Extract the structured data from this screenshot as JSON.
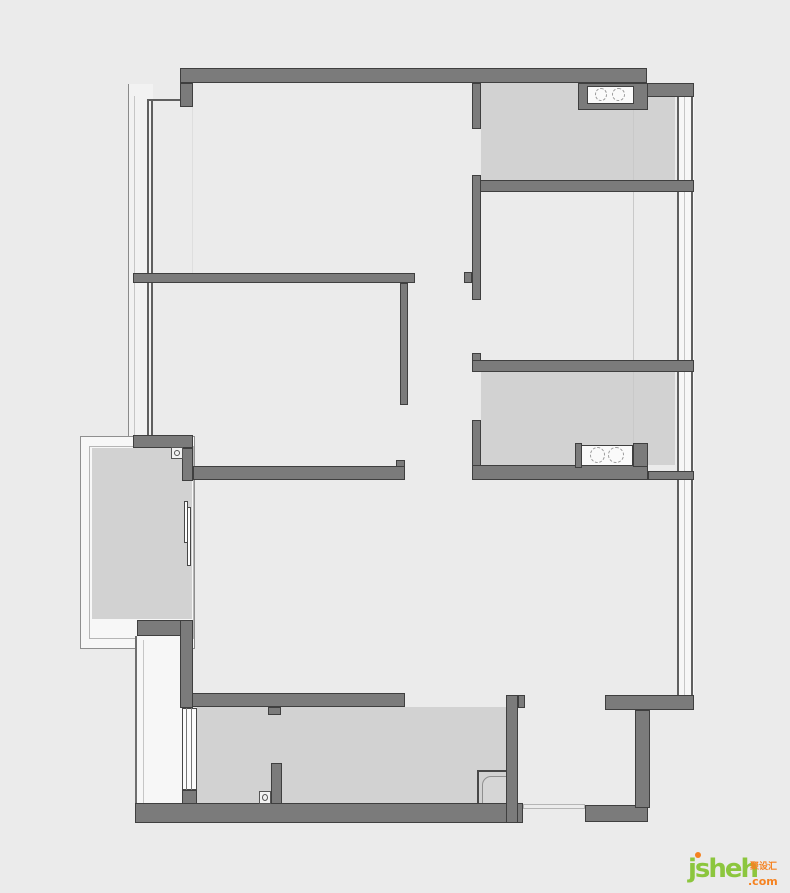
{
  "canvas": {
    "width": 790,
    "height": 893,
    "bg": "#ebebeb"
  },
  "palette": {
    "bg": "#ebebeb",
    "wall": "#7b7b7b",
    "wallEdge": "#3f3f3f",
    "shade": "#d2d2d2",
    "white": "#f7f7f7",
    "glass": "#fbfbfb",
    "lineDark": "#5f5f5f",
    "lineFaint": "#c6c6c6",
    "edge": "#8f8f8f",
    "inner": "#b5b5b5",
    "iconEdge": "#474747",
    "green": "#8cc63e",
    "orange": "#f58220"
  },
  "watermark": {
    "brand": "jsheh",
    "tld": ".com",
    "cjk": "聚设汇",
    "green": "#8cc63e",
    "orange": "#f58220"
  },
  "elements": [
    {
      "n": "left-window-band-upper",
      "fill": "#f2f2f2",
      "x": 128,
      "y": 84,
      "w": 25,
      "h": 352
    },
    {
      "n": "balcony-frame-outer",
      "fill": "$white",
      "stroke": "$edge",
      "sw": 1,
      "x": 80,
      "y": 436,
      "w": 115,
      "h": 213
    },
    {
      "n": "balcony-frame-inner-line",
      "stroke": "$inner",
      "sw": 1,
      "x": 89,
      "y": 446,
      "w": 105,
      "h": 193
    },
    {
      "n": "left-window-band-lower",
      "fill": "$white",
      "x": 135,
      "y": 636,
      "w": 47,
      "h": 168
    },
    {
      "n": "right-window-band",
      "fill": "$white",
      "x": 677,
      "y": 97,
      "w": 17,
      "h": 613
    },
    {
      "n": "room-balcony",
      "fill": "$shade",
      "x": 92,
      "y": 448,
      "w": 100,
      "h": 171
    },
    {
      "n": "room-bathroom-top",
      "fill": "$shade",
      "x": 481,
      "y": 83,
      "w": 194,
      "h": 97
    },
    {
      "n": "room-bathroom-mid",
      "fill": "$shade",
      "x": 481,
      "y": 372,
      "w": 194,
      "h": 93
    },
    {
      "n": "room-kitchen",
      "fill": "$shade",
      "x": 197,
      "y": 707,
      "w": 309,
      "h": 97
    },
    {
      "n": "shadow-line-living",
      "fill": "#dedede",
      "x": 192,
      "y": 85,
      "w": 1,
      "h": 188
    },
    {
      "n": "shadow-line-right",
      "fill": "#c9c9c9",
      "x": 633,
      "y": 84,
      "w": 1,
      "h": 381
    },
    {
      "n": "window-line-outer-left",
      "fill": "#8a8a8a",
      "x": 128,
      "y": 84,
      "w": 1,
      "h": 352
    },
    {
      "n": "window-line-faint-left",
      "fill": "$lineFaint",
      "x": 134,
      "y": 96,
      "w": 1,
      "h": 340
    },
    {
      "n": "window-glass-line-left-a",
      "fill": "$lineDark",
      "x": 147,
      "y": 99,
      "w": 2,
      "h": 337
    },
    {
      "n": "window-glass-line-left-b",
      "fill": "$lineDark",
      "x": 151,
      "y": 99,
      "w": 2,
      "h": 337
    },
    {
      "n": "window-glass-top-connector",
      "fill": "$lineDark",
      "x": 147,
      "y": 99,
      "w": 46,
      "h": 2
    },
    {
      "n": "window-line-lower-a",
      "fill": "#6f6f6f",
      "x": 135,
      "y": 636,
      "w": 2,
      "h": 168
    },
    {
      "n": "window-line-lower-faint",
      "fill": "$lineFaint",
      "x": 143,
      "y": 640,
      "w": 1,
      "h": 164
    },
    {
      "n": "window-glass-right-a",
      "fill": "$lineDark",
      "x": 677,
      "y": 97,
      "w": 2,
      "h": 613
    },
    {
      "n": "window-glass-right-mid",
      "fill": "$lineFaint",
      "x": 684,
      "y": 97,
      "w": 1,
      "h": 613
    },
    {
      "n": "window-glass-right-b",
      "fill": "$lineDark",
      "x": 691,
      "y": 97,
      "w": 2,
      "h": 613
    },
    {
      "n": "kitchen-window-glass",
      "fill": "$glass",
      "stroke": "$iconEdge",
      "sw": 1,
      "x": 182,
      "y": 708,
      "w": 15,
      "h": 82
    },
    {
      "n": "kitchen-window-line-a",
      "fill": "#777777",
      "x": 186,
      "y": 708,
      "w": 1,
      "h": 82
    },
    {
      "n": "kitchen-window-line-b",
      "fill": "#777777",
      "x": 191,
      "y": 708,
      "w": 1,
      "h": 82
    },
    {
      "n": "balcony-door-panel-a",
      "fill": "#fdfdfd",
      "stroke": "$iconEdge",
      "sw": 1,
      "x": 184,
      "y": 501,
      "w": 4,
      "h": 42
    },
    {
      "n": "balcony-door-panel-b",
      "fill": "#fdfdfd",
      "stroke": "$iconEdge",
      "sw": 1,
      "x": 187,
      "y": 507,
      "w": 4,
      "h": 59
    },
    {
      "n": "kitchen-corner-box",
      "fill": "$shade",
      "stroke": "#474747",
      "sw": 2,
      "x": 477,
      "y": 770,
      "w": 32,
      "h": 35
    },
    {
      "n": "kitchen-corner-box-inner",
      "fill": "#d6d6d6",
      "stroke": "#8f8f8f",
      "sw": 1,
      "rad": "9px 0 0 0",
      "x": 482,
      "y": 776,
      "w": 27,
      "h": 29
    },
    {
      "n": "wall-top",
      "k": "wall",
      "x": 180,
      "y": 68,
      "w": 467,
      "h": 15
    },
    {
      "n": "wall-top-left-stub",
      "k": "wall",
      "x": 180,
      "y": 83,
      "w": 13,
      "h": 24
    },
    {
      "n": "wall-top-right-step",
      "k": "wall",
      "x": 647,
      "y": 83,
      "w": 47,
      "h": 14
    },
    {
      "n": "wall-bath-top-left",
      "k": "wall",
      "x": 472,
      "y": 83,
      "w": 9,
      "h": 46
    },
    {
      "n": "wall-bath-top-niche-block",
      "k": "wall",
      "x": 578,
      "y": 83,
      "w": 70,
      "h": 27
    },
    {
      "n": "wall-bath-top-bottom",
      "k": "wall",
      "x": 472,
      "y": 180,
      "w": 222,
      "h": 12
    },
    {
      "n": "wall-bedroom-right-left",
      "k": "wall",
      "x": 472,
      "y": 175,
      "w": 9,
      "h": 125
    },
    {
      "n": "wall-hall-stub",
      "k": "wall",
      "x": 464,
      "y": 272,
      "w": 8,
      "h": 11
    },
    {
      "n": "wall-bath-mid-topstub",
      "k": "wall",
      "x": 472,
      "y": 353,
      "w": 9,
      "h": 19
    },
    {
      "n": "wall-bath-mid-top",
      "k": "wall",
      "x": 472,
      "y": 360,
      "w": 222,
      "h": 12
    },
    {
      "n": "wall-bath-mid-left",
      "k": "wall",
      "x": 472,
      "y": 420,
      "w": 9,
      "h": 60
    },
    {
      "n": "wall-bath-mid-bottom",
      "k": "wall",
      "x": 472,
      "y": 465,
      "w": 176,
      "h": 15
    },
    {
      "n": "wall-bath-mid-bottom-ext",
      "k": "wall",
      "x": 648,
      "y": 471,
      "w": 46,
      "h": 9
    },
    {
      "n": "wall-bath-mid-niche-left",
      "k": "wall",
      "x": 575,
      "y": 443,
      "w": 7,
      "h": 25
    },
    {
      "n": "wall-bath-mid-niche-right",
      "k": "wall",
      "x": 633,
      "y": 443,
      "w": 15,
      "h": 24
    },
    {
      "n": "wall-mid-horizontal",
      "k": "wall",
      "x": 133,
      "y": 273,
      "w": 282,
      "h": 10
    },
    {
      "n": "wall-bedroom-left-right",
      "k": "wall",
      "x": 400,
      "y": 283,
      "w": 8,
      "h": 122
    },
    {
      "n": "wall-bedroom-left-bottom",
      "k": "wall",
      "x": 193,
      "y": 466,
      "w": 212,
      "h": 14
    },
    {
      "n": "wall-bedroom-left-bottom-stub",
      "k": "wall",
      "x": 396,
      "y": 460,
      "w": 9,
      "h": 7
    },
    {
      "n": "wall-balcony-top",
      "k": "wall",
      "x": 133,
      "y": 435,
      "w": 60,
      "h": 13
    },
    {
      "n": "wall-balcony-right-upper",
      "k": "wall",
      "x": 182,
      "y": 448,
      "w": 11,
      "h": 33
    },
    {
      "n": "wall-balcony-bottom",
      "k": "wall",
      "x": 137,
      "y": 620,
      "w": 46,
      "h": 16
    },
    {
      "n": "wall-balcony-right-lower",
      "k": "wall",
      "x": 180,
      "y": 620,
      "w": 13,
      "h": 88
    },
    {
      "n": "wall-kitchen-window-jamb",
      "k": "wall",
      "x": 182,
      "y": 790,
      "w": 15,
      "h": 16
    },
    {
      "n": "wall-kitchen-top",
      "k": "wall",
      "x": 192,
      "y": 693,
      "w": 213,
      "h": 14
    },
    {
      "n": "wall-kitchen-top-stub",
      "k": "wall",
      "x": 268,
      "y": 707,
      "w": 13,
      "h": 8
    },
    {
      "n": "wall-kitchen-partition",
      "k": "wall",
      "x": 271,
      "y": 763,
      "w": 11,
      "h": 42
    },
    {
      "n": "wall-bottom-main",
      "k": "wall",
      "x": 135,
      "y": 803,
      "w": 388,
      "h": 20
    },
    {
      "n": "wall-bottom-entry",
      "k": "wall",
      "x": 585,
      "y": 805,
      "w": 63,
      "h": 17
    },
    {
      "n": "wall-entry-right",
      "k": "wall",
      "x": 635,
      "y": 710,
      "w": 15,
      "h": 98
    },
    {
      "n": "wall-entry-top",
      "k": "wall",
      "x": 605,
      "y": 695,
      "w": 89,
      "h": 15
    },
    {
      "n": "wall-kitchen-right",
      "k": "wall",
      "x": 506,
      "y": 695,
      "w": 12,
      "h": 128
    },
    {
      "n": "wall-kitchen-right-stub",
      "k": "wall",
      "x": 518,
      "y": 695,
      "w": 7,
      "h": 13
    },
    {
      "n": "vanity-top-box",
      "fill": "#fafafa",
      "stroke": "$wallEdge",
      "sw": 1,
      "x": 587,
      "y": 86,
      "w": 47,
      "h": 18
    },
    {
      "n": "vanity-top-basin-left",
      "k": "dash",
      "stroke": "#9a9a9a",
      "x": 595,
      "y": 88,
      "w": 12,
      "h": 13
    },
    {
      "n": "vanity-top-basin-right",
      "k": "dash",
      "stroke": "#9a9a9a",
      "x": 612,
      "y": 88,
      "w": 13,
      "h": 13
    },
    {
      "n": "vanity-mid-box",
      "fill": "#fafafa",
      "stroke": "$wallEdge",
      "sw": 1,
      "x": 581,
      "y": 445,
      "w": 52,
      "h": 21
    },
    {
      "n": "vanity-mid-basin-left",
      "k": "dash",
      "stroke": "#9a9a9a",
      "x": 590,
      "y": 447,
      "w": 15,
      "h": 16
    },
    {
      "n": "vanity-mid-basin-right",
      "k": "dash",
      "stroke": "#9a9a9a",
      "x": 608,
      "y": 447,
      "w": 16,
      "h": 16
    },
    {
      "n": "meter-icon-balcony",
      "k": "meter",
      "x": 171,
      "y": 447,
      "w": 12,
      "h": 12
    },
    {
      "n": "meter-icon-kitchen",
      "k": "meter",
      "x": 259,
      "y": 791,
      "w": 12,
      "h": 13
    },
    {
      "n": "entry-threshold",
      "fill": "#ececec",
      "stroke": "#b5b5b5",
      "sw": 1,
      "x": 523,
      "y": 804,
      "w": 62,
      "h": 5
    }
  ]
}
